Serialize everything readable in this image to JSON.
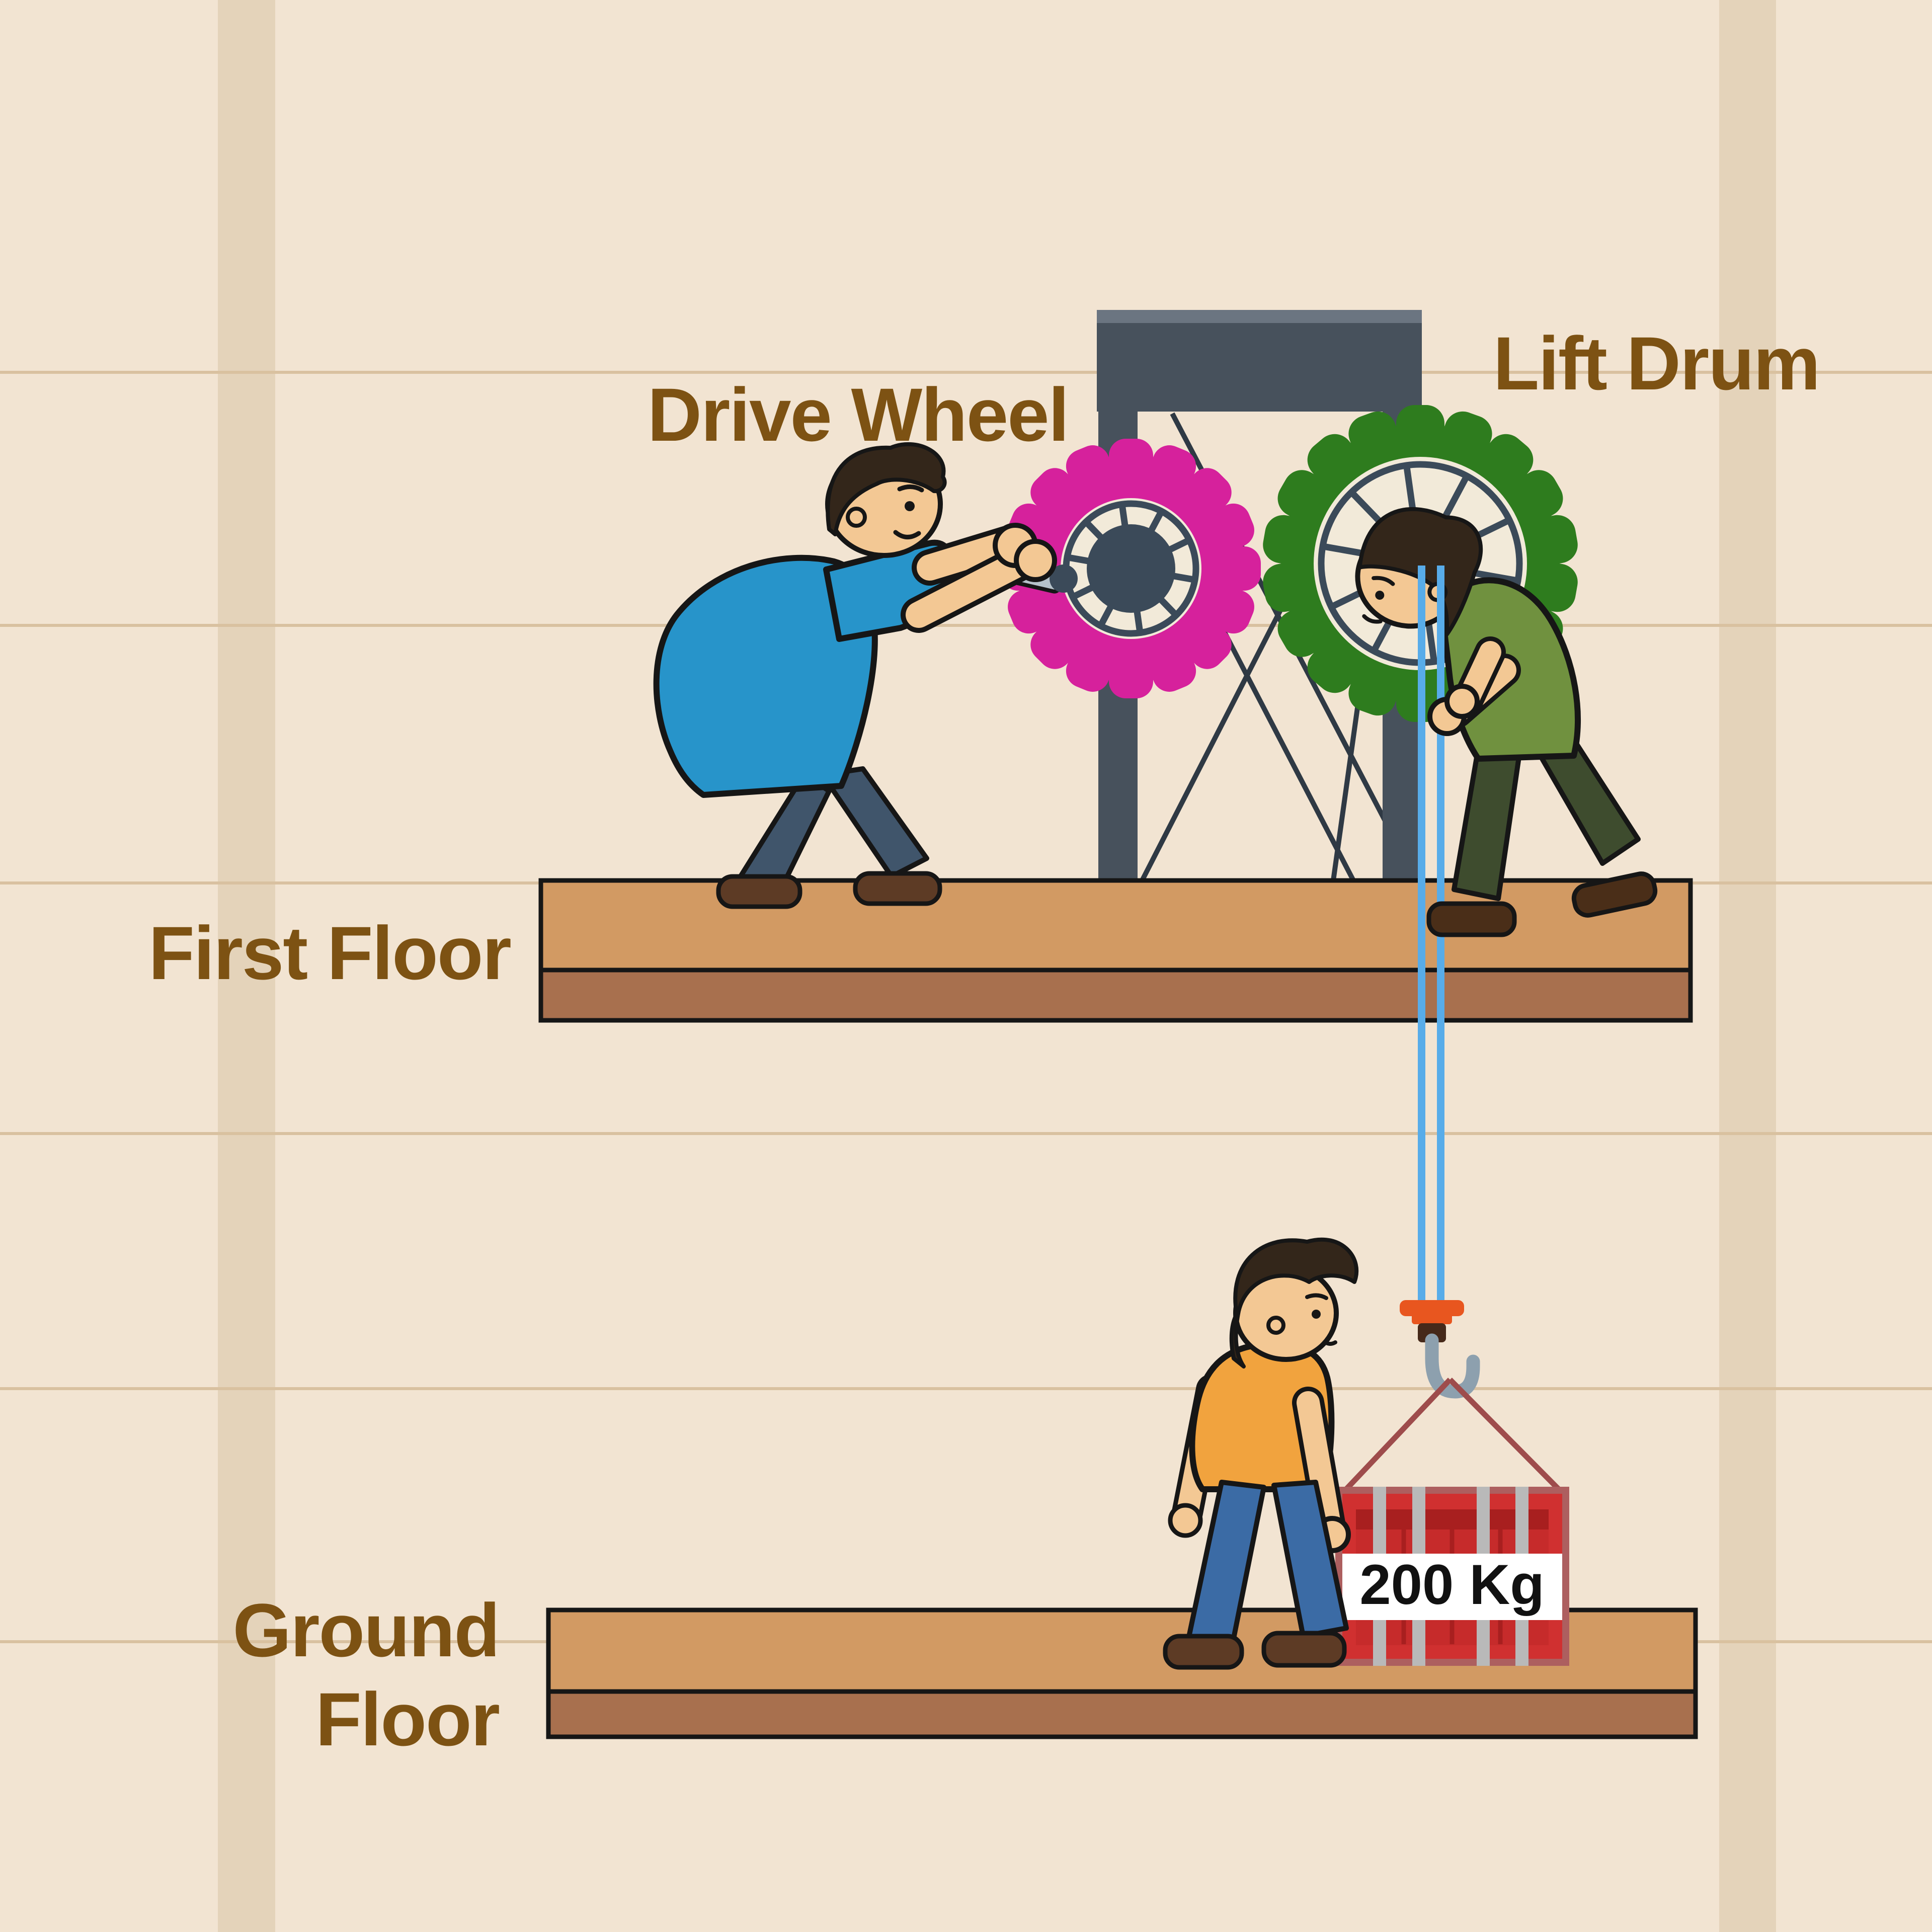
{
  "labels": {
    "drive_wheel": "Drive Wheel",
    "lift_drum": "Lift Drum",
    "first_floor": "First Floor",
    "ground_floor_line1": "Ground",
    "ground_floor_line2": "Floor",
    "load_weight": "200 Kg"
  },
  "diagram": {
    "gears": [
      {
        "id": "drive-wheel",
        "label": "Drive Wheel",
        "color": "#d6219c",
        "teeth": 16,
        "spokes": 10
      },
      {
        "id": "lift-drum",
        "label": "Lift Drum",
        "color": "#2e7c1e",
        "teeth": 18,
        "spokes": 10
      }
    ],
    "ropes": {
      "count": 2,
      "color": "#58ace9"
    },
    "load": {
      "weight": "200 Kg",
      "crate_color": "#d03030"
    },
    "floors": [
      "First Floor",
      "Ground Floor"
    ]
  },
  "colors": {
    "wall_bg": "#f2e4d2",
    "wall_stripe": "#e4d3ba",
    "wall_line": "#d9c1a0",
    "label_brown": "#7d5213",
    "frame": "#47515c",
    "frame_light": "#6b7581",
    "brace": "#2f3944",
    "platform_top": "#d29a63",
    "platform_bottom": "#a8704e",
    "gear_disc": "#f2ead9",
    "gear_metal": "#3b4a59",
    "rope_blue": "#58ace9",
    "hook_gray": "#8da0ae",
    "cap_orange": "#e8561f",
    "shank_brown": "#46291a",
    "sling": "#9e4c4c",
    "crate_red": "#d03030",
    "crate_dark": "#a81f1f",
    "crate_panel": "#c62b2b",
    "crate_strap": "#b9b9b9",
    "crate_border": "#ad5f5f",
    "skin": "#f3c894",
    "hair": "#33261a",
    "shirt_blue": "#2794ca",
    "pants_blue_gray": "#40556b",
    "shirt_green": "#70913f",
    "pants_olive": "#3e4c2e",
    "shirt_orange": "#f1a33e",
    "jeans": "#3b6ba5",
    "shoe": "#5d3b25",
    "shoe_dark": "#4a2e18",
    "outline": "#161616"
  }
}
